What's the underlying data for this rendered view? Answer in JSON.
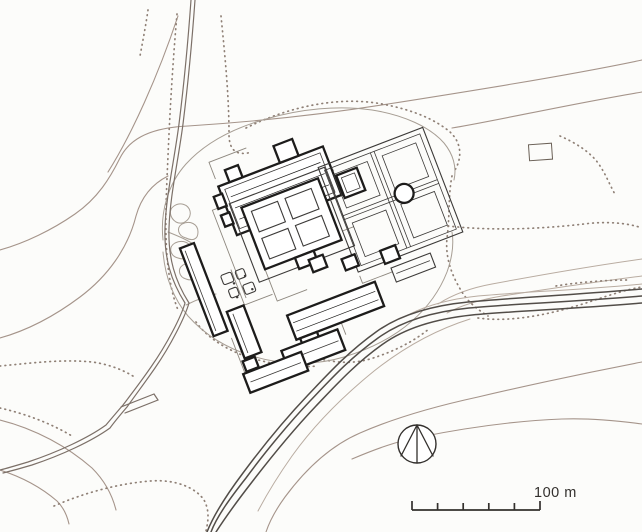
{
  "colors": {
    "paper": "#fcfcfa",
    "ink": "#33302d",
    "contour": "#a5948a",
    "contour_light": "#b9aca1",
    "dots": "#8f8076",
    "road": "#7c7068",
    "river": "#524d48",
    "building": "#1d1c1b",
    "building_thin": "#3c3a38",
    "enclosure": "#8e887f",
    "platform": "#a79e94"
  },
  "scale_bar": {
    "label": "100 m",
    "segments": 5
  },
  "icons": {
    "north_arrow": "compass-north-arrow",
    "pond": "circular-pond",
    "scale": "graphic-scale-bar"
  }
}
